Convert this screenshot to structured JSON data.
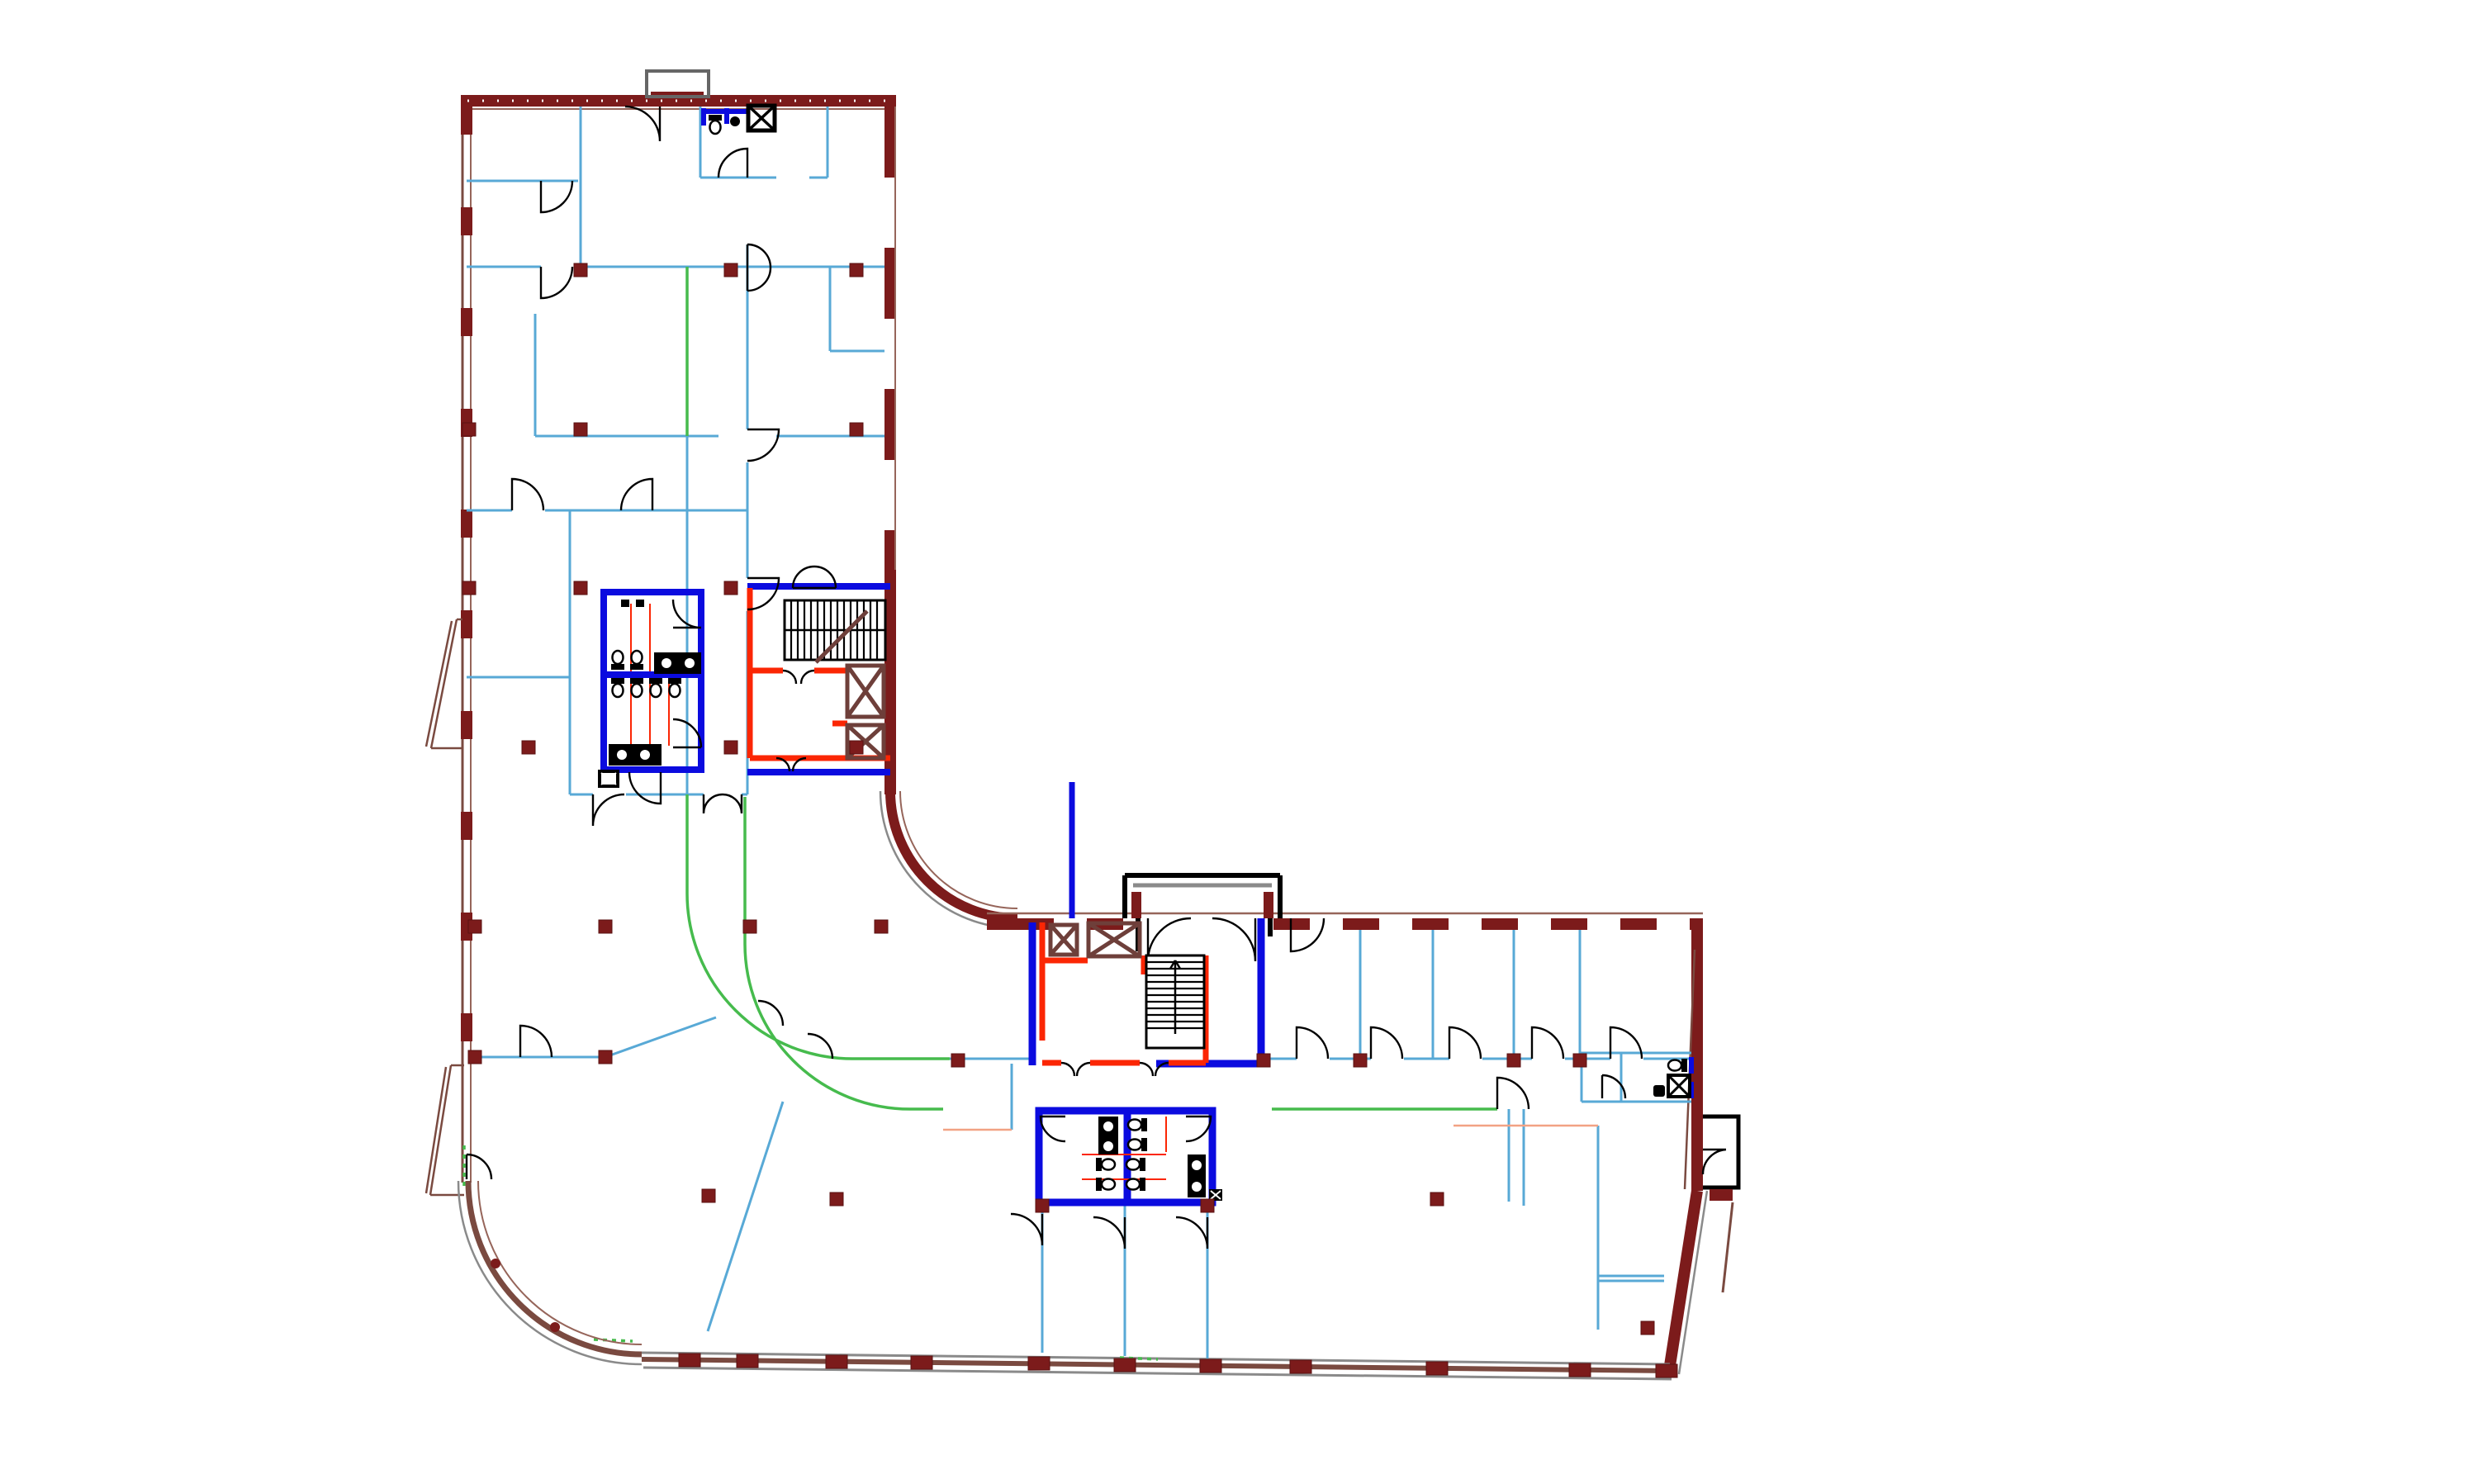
{
  "palette": {
    "exterior_wall": "#7c1b1b",
    "exterior_window_band": "#96655a",
    "exterior_brown": "#7a4a40",
    "shaft_brown": "#6e3f3a",
    "sidewalk_gray": "#8a8a8a",
    "partition_cyan": "#58a9d6",
    "wet_wall_blue": "#0b0bdf",
    "egress_red": "#fb2604",
    "glazing_green": "#46bb4d",
    "accent_salmon": "#f2a284",
    "linework_black": "#000000",
    "background": "#ffffff"
  },
  "plan": {
    "columns": [
      [
        703,
        327
      ],
      [
        885,
        327
      ],
      [
        1037,
        327
      ],
      [
        568,
        520
      ],
      [
        703,
        520
      ],
      [
        1037,
        520
      ],
      [
        568,
        712
      ],
      [
        703,
        712
      ],
      [
        885,
        712
      ],
      [
        640,
        905
      ],
      [
        885,
        905
      ],
      [
        1037,
        905
      ],
      [
        575,
        1122
      ],
      [
        733,
        1122
      ],
      [
        908,
        1122
      ],
      [
        1067,
        1122
      ],
      [
        575,
        1280
      ],
      [
        733,
        1280
      ],
      [
        1160,
        1284
      ],
      [
        1530,
        1284
      ],
      [
        1647,
        1284
      ],
      [
        1833,
        1284
      ],
      [
        1913,
        1284
      ],
      [
        858,
        1448
      ],
      [
        1013,
        1452
      ],
      [
        1740,
        1452
      ],
      [
        1262,
        1460
      ],
      [
        1462,
        1460
      ],
      [
        1995,
        1608
      ]
    ],
    "bottom_wall_piers": [
      [
        835,
        1647
      ],
      [
        905,
        1648
      ],
      [
        1013,
        1649
      ],
      [
        1116,
        1650
      ],
      [
        1258,
        1651
      ],
      [
        1362,
        1653
      ],
      [
        1466,
        1654
      ],
      [
        1575,
        1655
      ],
      [
        1740,
        1657
      ],
      [
        1913,
        1659
      ],
      [
        2018,
        1660
      ]
    ],
    "toilets": [
      [
        748,
        800,
        180
      ],
      [
        771,
        800,
        180
      ],
      [
        748,
        832,
        0
      ],
      [
        771,
        832,
        0
      ],
      [
        794,
        832,
        0
      ],
      [
        817,
        832,
        0
      ],
      [
        866,
        150,
        0
      ],
      [
        1378,
        1362,
        90
      ],
      [
        1378,
        1386,
        90
      ],
      [
        1338,
        1410,
        270
      ],
      [
        1376,
        1410,
        90
      ],
      [
        1338,
        1434,
        270
      ],
      [
        1376,
        1434,
        90
      ],
      [
        2032,
        1290,
        90
      ]
    ],
    "features": {
      "stairs": 2,
      "elevators": 4,
      "service_shafts": 4,
      "restroom_groups": 4,
      "entrance_vestibules": 2,
      "curved_corners": 2
    }
  }
}
